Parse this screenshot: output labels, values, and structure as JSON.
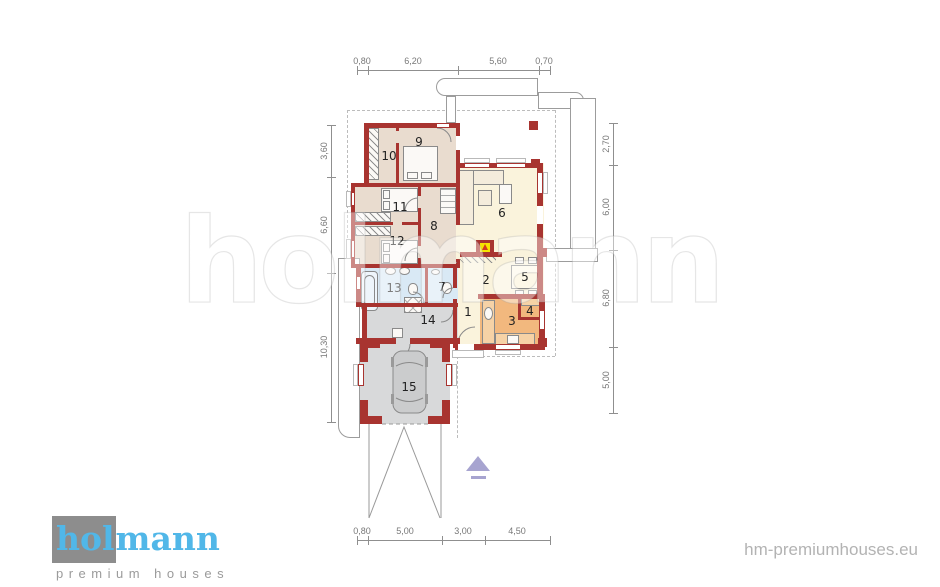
{
  "watermark": "holmann",
  "logo": {
    "highlight": "hol",
    "rest": "mann",
    "tagline": "premium houses"
  },
  "footer_url": "hm-premiumhouses.eu",
  "dims": {
    "top": [
      "0,80",
      "6,20",
      "5,60",
      "0,70"
    ],
    "bottom": [
      "0,80",
      "5,00",
      "3,00",
      "4,50"
    ],
    "left": [
      "3,60",
      "6,60",
      "10,30"
    ],
    "right": [
      "2,70",
      "6,00",
      "6,80",
      "5,00"
    ]
  },
  "rooms": {
    "r1": "1",
    "r2": "2",
    "r3": "3",
    "r4": "4",
    "r5": "5",
    "r6": "6",
    "r7": "7",
    "r8": "8",
    "r9": "9",
    "r10": "10",
    "r11": "11",
    "r12": "12",
    "r13": "13",
    "r14": "14",
    "r15": "15"
  },
  "colors": {
    "wall": "#a83430",
    "bedroom": "#e9dccf",
    "living": "#faf3dc",
    "bathroom": "#d9e9f5",
    "kitchen": "#f2b87e",
    "garage": "#d8d9da",
    "logo_blue": "#51b7e8",
    "logo_gray": "#8d8d8d",
    "arrow_purple": "#a7a4d0"
  }
}
